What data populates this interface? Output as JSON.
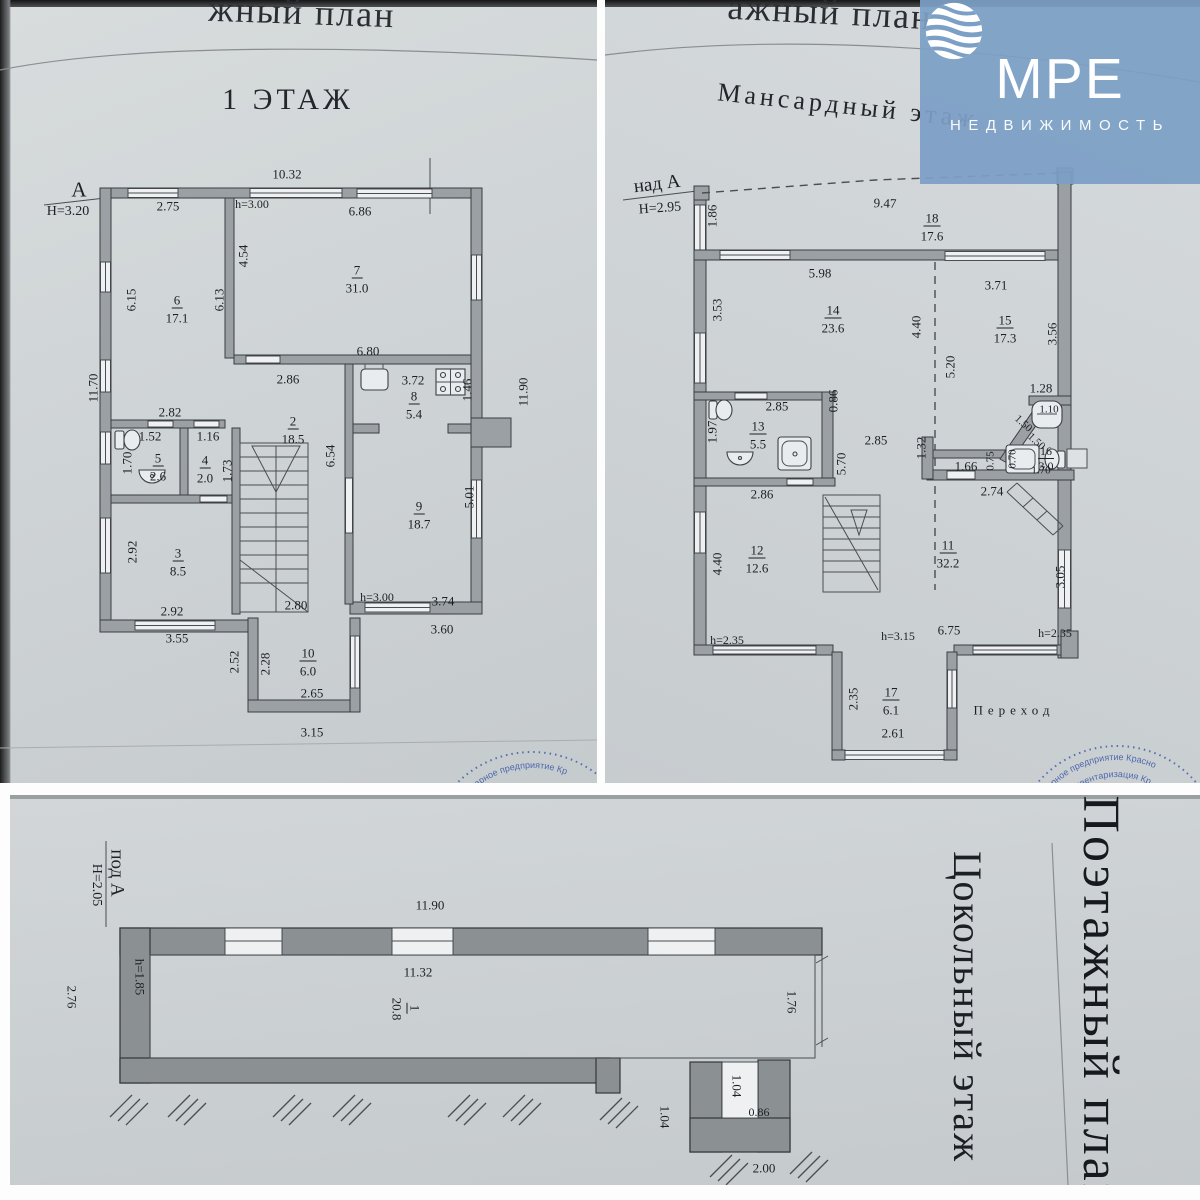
{
  "logo": {
    "m": "М",
    "re": "РЕ",
    "subtitle": "НЕДВИЖИМОСТЬ"
  },
  "plan1": {
    "stamp": {
      "arc1": "нитарное предприятие Кр"
    },
    "labels": [
      {
        "t": "жный план",
        "x": 302,
        "y": 12,
        "fs": 36,
        "r": 2,
        "cls": "frag",
        "n": "page-header-fragment"
      },
      {
        "t": "1 ЭТАЖ",
        "x": 288,
        "y": 100,
        "fs": 30,
        "cls": "title",
        "n": "plan1-title"
      },
      {
        "t": "А",
        "x": 79,
        "y": 190,
        "fs": 21,
        "n": "axis-label"
      },
      {
        "t": "Н=3.20",
        "x": 68,
        "y": 212,
        "fs": 14,
        "n": "height-label"
      },
      {
        "t": "10.32",
        "x": 287,
        "y": 174
      },
      {
        "t": "2.75",
        "x": 168,
        "y": 206
      },
      {
        "t": "h=3.00",
        "x": 252,
        "y": 204,
        "fs": 12
      },
      {
        "t": "6.86",
        "x": 360,
        "y": 211
      },
      {
        "t": "4.54",
        "x": 243,
        "y": 256,
        "r": -90
      },
      {
        "t": "6.15",
        "x": 131,
        "y": 300,
        "r": -90
      },
      {
        "t": "6.13",
        "x": 219,
        "y": 300,
        "r": -90
      },
      {
        "t": "6",
        "x": 177,
        "y": 301,
        "u": 1,
        "n": "room-number"
      },
      {
        "t": "17.1",
        "x": 177,
        "y": 318,
        "n": "room-area"
      },
      {
        "t": "7",
        "x": 357,
        "y": 271,
        "u": 1,
        "n": "room-number"
      },
      {
        "t": "31.0",
        "x": 357,
        "y": 288,
        "n": "room-area"
      },
      {
        "t": "11.70",
        "x": 93,
        "y": 388,
        "r": -90
      },
      {
        "t": "11.90",
        "x": 523,
        "y": 392,
        "r": -90
      },
      {
        "t": "6.80",
        "x": 368,
        "y": 351
      },
      {
        "t": "2.86",
        "x": 288,
        "y": 379
      },
      {
        "t": "3.72",
        "x": 413,
        "y": 380
      },
      {
        "t": "8",
        "x": 414,
        "y": 397,
        "u": 1,
        "n": "room-number"
      },
      {
        "t": "5.4",
        "x": 414,
        "y": 414,
        "n": "room-area"
      },
      {
        "t": "1.46",
        "x": 467,
        "y": 390,
        "r": -90
      },
      {
        "t": "2.82",
        "x": 170,
        "y": 412
      },
      {
        "t": "1.52",
        "x": 150,
        "y": 436
      },
      {
        "t": "1.16",
        "x": 208,
        "y": 436
      },
      {
        "t": "2",
        "x": 293,
        "y": 422,
        "u": 1,
        "n": "room-number"
      },
      {
        "t": "18.5",
        "x": 293,
        "y": 439,
        "n": "room-area"
      },
      {
        "t": "1.70",
        "x": 127,
        "y": 463,
        "r": -90
      },
      {
        "t": "5",
        "x": 158,
        "y": 459,
        "u": 1,
        "n": "room-number"
      },
      {
        "t": "2.6",
        "x": 158,
        "y": 476,
        "n": "room-area"
      },
      {
        "t": "4",
        "x": 205,
        "y": 461,
        "u": 1,
        "n": "room-number"
      },
      {
        "t": "2.0",
        "x": 205,
        "y": 478,
        "n": "room-area"
      },
      {
        "t": "1.73",
        "x": 227,
        "y": 471,
        "r": -90
      },
      {
        "t": "6.54",
        "x": 330,
        "y": 456,
        "r": -90
      },
      {
        "t": "9",
        "x": 419,
        "y": 507,
        "u": 1,
        "n": "room-number"
      },
      {
        "t": "18.7",
        "x": 419,
        "y": 524,
        "n": "room-area"
      },
      {
        "t": "5.01",
        "x": 469,
        "y": 497,
        "r": -90
      },
      {
        "t": "2.92",
        "x": 132,
        "y": 552,
        "r": -90
      },
      {
        "t": "3",
        "x": 178,
        "y": 554,
        "u": 1,
        "n": "room-number"
      },
      {
        "t": "8.5",
        "x": 178,
        "y": 571,
        "n": "room-area"
      },
      {
        "t": "2.92",
        "x": 172,
        "y": 611
      },
      {
        "t": "2.80",
        "x": 296,
        "y": 605
      },
      {
        "t": "h=3.00",
        "x": 377,
        "y": 597,
        "fs": 12
      },
      {
        "t": "3.74",
        "x": 443,
        "y": 601
      },
      {
        "t": "3.55",
        "x": 177,
        "y": 638
      },
      {
        "t": "3.60",
        "x": 442,
        "y": 629
      },
      {
        "t": "2.52",
        "x": 234,
        "y": 662,
        "r": -90
      },
      {
        "t": "2.28",
        "x": 265,
        "y": 664,
        "r": -90
      },
      {
        "t": "10",
        "x": 308,
        "y": 654,
        "u": 1,
        "n": "room-number"
      },
      {
        "t": "6.0",
        "x": 308,
        "y": 671,
        "n": "room-area"
      },
      {
        "t": "2.65",
        "x": 312,
        "y": 693
      },
      {
        "t": "3.15",
        "x": 312,
        "y": 732
      }
    ]
  },
  "plan2": {
    "stamp": {
      "arc1": "тарное предприятие Красно",
      "arc2": "ая инвентаризация Кр"
    },
    "labels": [
      {
        "t": "ажный план",
        "x": 225,
        "y": 12,
        "fs": 36,
        "r": 3,
        "cls": "frag",
        "n": "page-header-fragment"
      },
      {
        "t": "Мансардный этаж",
        "x": 243,
        "y": 106,
        "fs": 26,
        "r": 6,
        "cls": "title",
        "n": "plan2-title"
      },
      {
        "t": "над А",
        "x": 52,
        "y": 184,
        "fs": 19,
        "r": -7,
        "n": "axis-label"
      },
      {
        "t": "Н=2.95",
        "x": 55,
        "y": 209,
        "fs": 14,
        "r": -4,
        "n": "height-label"
      },
      {
        "t": "1.86",
        "x": 107,
        "y": 216,
        "r": -90
      },
      {
        "t": "9.47",
        "x": 280,
        "y": 203,
        "r": 2
      },
      {
        "t": "18",
        "x": 327,
        "y": 219,
        "u": 1,
        "n": "room-number"
      },
      {
        "t": "17.6",
        "x": 327,
        "y": 236,
        "n": "room-area"
      },
      {
        "t": "5.98",
        "x": 215,
        "y": 273
      },
      {
        "t": "3.71",
        "x": 391,
        "y": 285
      },
      {
        "t": "14",
        "x": 228,
        "y": 311,
        "u": 1,
        "n": "room-number"
      },
      {
        "t": "23.6",
        "x": 228,
        "y": 328,
        "n": "room-area"
      },
      {
        "t": "3.53",
        "x": 112,
        "y": 310,
        "r": -90
      },
      {
        "t": "4.40",
        "x": 311,
        "y": 327,
        "r": -90
      },
      {
        "t": "5.20",
        "x": 345,
        "y": 367,
        "r": -90
      },
      {
        "t": "15",
        "x": 400,
        "y": 321,
        "u": 1,
        "n": "room-number"
      },
      {
        "t": "17.3",
        "x": 400,
        "y": 338,
        "n": "room-area"
      },
      {
        "t": "3.56",
        "x": 447,
        "y": 334,
        "r": -90
      },
      {
        "t": "1.28",
        "x": 436,
        "y": 388
      },
      {
        "t": "1.10",
        "x": 444,
        "y": 410,
        "fs": 11
      },
      {
        "t": "1.50",
        "x": 418,
        "y": 424,
        "r": 42,
        "fs": 11
      },
      {
        "t": "1.50",
        "x": 431,
        "y": 442,
        "r": 42,
        "fs": 11
      },
      {
        "t": "16",
        "x": 441,
        "y": 452,
        "u": 1,
        "fs": 12,
        "n": "room-number"
      },
      {
        "t": "3.0",
        "x": 441,
        "y": 466,
        "fs": 12,
        "n": "room-area"
      },
      {
        "t": "0.70",
        "x": 408,
        "y": 459,
        "r": -90,
        "fs": 11
      },
      {
        "t": "1.70",
        "x": 436,
        "y": 471,
        "fs": 11
      },
      {
        "t": "2.85",
        "x": 172,
        "y": 406
      },
      {
        "t": "13",
        "x": 153,
        "y": 427,
        "u": 1,
        "n": "room-number"
      },
      {
        "t": "5.5",
        "x": 153,
        "y": 444,
        "n": "room-area"
      },
      {
        "t": "1.97",
        "x": 107,
        "y": 432,
        "r": -90
      },
      {
        "t": "0.86",
        "x": 228,
        "y": 401,
        "r": -90
      },
      {
        "t": "2.85",
        "x": 271,
        "y": 440
      },
      {
        "t": "5.70",
        "x": 236,
        "y": 464,
        "r": -90
      },
      {
        "t": "1.32",
        "x": 316,
        "y": 448,
        "r": -90
      },
      {
        "t": "1.66",
        "x": 361,
        "y": 466
      },
      {
        "t": "0.75",
        "x": 386,
        "y": 461,
        "r": -90,
        "fs": 11
      },
      {
        "t": "2.74",
        "x": 387,
        "y": 491
      },
      {
        "t": "2.86",
        "x": 157,
        "y": 494
      },
      {
        "t": "12",
        "x": 152,
        "y": 551,
        "u": 1,
        "n": "room-number"
      },
      {
        "t": "12.6",
        "x": 152,
        "y": 568,
        "n": "room-area"
      },
      {
        "t": "4.40",
        "x": 112,
        "y": 564,
        "r": -90
      },
      {
        "t": "11",
        "x": 343,
        "y": 546,
        "u": 1,
        "n": "room-number"
      },
      {
        "t": "32.2",
        "x": 343,
        "y": 563,
        "n": "room-area"
      },
      {
        "t": "3.05",
        "x": 455,
        "y": 577,
        "r": -90
      },
      {
        "t": "h=2.35",
        "x": 122,
        "y": 640,
        "fs": 12
      },
      {
        "t": "h=3.15",
        "x": 293,
        "y": 636,
        "fs": 12
      },
      {
        "t": "6.75",
        "x": 344,
        "y": 630
      },
      {
        "t": "h=2.35",
        "x": 450,
        "y": 633,
        "fs": 12
      },
      {
        "t": "17",
        "x": 286,
        "y": 693,
        "u": 1,
        "n": "room-number"
      },
      {
        "t": "6.1",
        "x": 286,
        "y": 710,
        "n": "room-area"
      },
      {
        "t": "2.35",
        "x": 248,
        "y": 699,
        "r": -90
      },
      {
        "t": "2.61",
        "x": 288,
        "y": 733
      },
      {
        "t": "Переход",
        "x": 409,
        "y": 710,
        "fs": 13,
        "ls": 5,
        "n": "label-perekhod"
      }
    ]
  },
  "basement": {
    "labels": [
      {
        "t": "под А",
        "x": 107,
        "y": 78,
        "r": 90,
        "fs": 19,
        "n": "axis-label"
      },
      {
        "t": "Н=2.05",
        "x": 86,
        "y": 90,
        "r": 90,
        "fs": 14,
        "n": "height-label"
      },
      {
        "t": "11.90",
        "x": 420,
        "y": 110
      },
      {
        "t": "11.32",
        "x": 408,
        "y": 177
      },
      {
        "t": "1",
        "x": 404,
        "y": 213,
        "r": 90,
        "u": 1,
        "n": "room-number"
      },
      {
        "t": "20.8",
        "x": 387,
        "y": 214,
        "r": 90,
        "n": "room-area"
      },
      {
        "t": "h=1.85",
        "x": 130,
        "y": 182,
        "r": 90,
        "fs": 13
      },
      {
        "t": "2.76",
        "x": 62,
        "y": 202,
        "r": 90
      },
      {
        "t": "1.76",
        "x": 782,
        "y": 207,
        "r": 90
      },
      {
        "t": "1.04",
        "x": 727,
        "y": 291,
        "r": 90
      },
      {
        "t": "0.86",
        "x": 749,
        "y": 317,
        "fs": 12
      },
      {
        "t": "1.04",
        "x": 655,
        "y": 322,
        "r": 90
      },
      {
        "t": "2.00",
        "x": 754,
        "y": 373
      },
      {
        "t": "Цокольный этаж",
        "x": 957,
        "y": 212,
        "r": 90,
        "fs": 40,
        "cls": "vtitle",
        "n": "basement-title"
      },
      {
        "t": "Поэтажный план",
        "x": 1090,
        "y": 210,
        "r": 90,
        "fs": 52,
        "cls": "vtitle2",
        "n": "page-title-vertical"
      }
    ]
  }
}
